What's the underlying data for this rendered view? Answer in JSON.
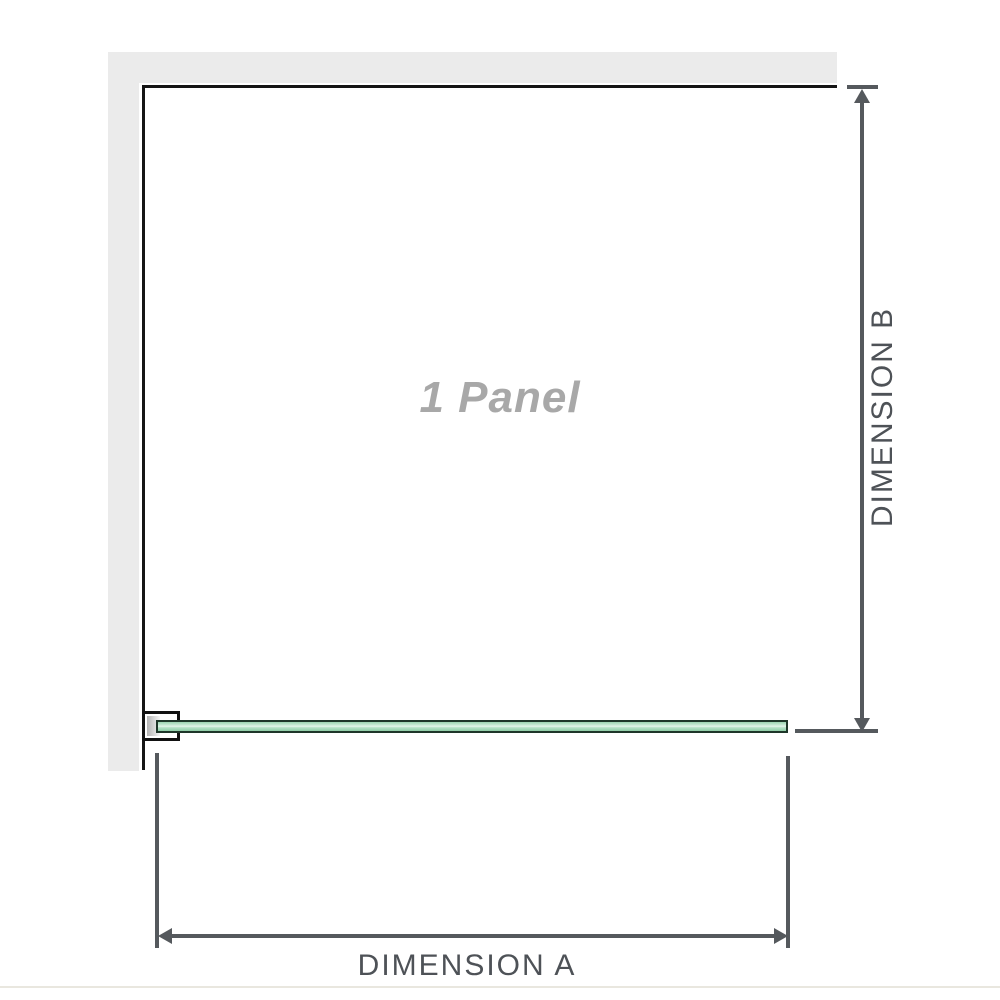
{
  "diagram": {
    "panel_label": "1 Panel",
    "dimension_a_label": "DIMENSION A",
    "dimension_b_label": "DIMENSION B"
  },
  "colors": {
    "wall-gray": "#ebebeb",
    "outline-black": "#151515",
    "dimension-gray": "#55595d",
    "text-gray": "#4e5257",
    "label-gray": "#a8a8a8",
    "glass-border": "#1e3629",
    "glass-green": "#9cd4b1",
    "baseline-beige": "#e9e7df"
  }
}
